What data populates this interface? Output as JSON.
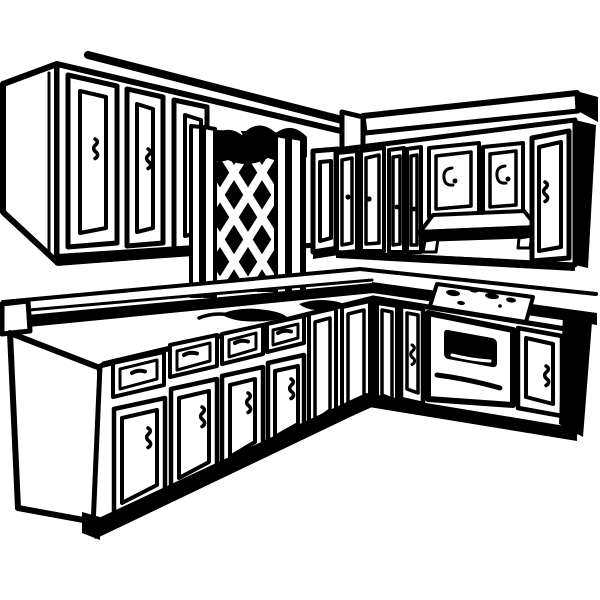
{
  "meta": {
    "alt": "Black and white clip-art line drawing of an L-shaped kitchen with upper cabinets, a lattice window, a range hood, a long countertop, base cabinets with drawers, and a built-in oven with cooktop burners.",
    "style": "black-and-white line illustration",
    "subject": "kitchen interior, corner perspective"
  },
  "palette": {
    "ink": "#000000",
    "paper": "#ffffff"
  },
  "scene": {
    "ceiling": {
      "trim_lines": 1
    },
    "upper_cabinets_left": {
      "side_panel": 1,
      "doors": 3,
      "partial_door": 1,
      "handle_style": "squiggle"
    },
    "lattice_window": {
      "type": "diamond lattice",
      "posts_left": 2,
      "posts_right": 2,
      "valance": true
    },
    "upper_cabinets_right": {
      "narrow_doors": 4,
      "square_doors_over_hood": 2,
      "wide_door": 1,
      "end_panel": "black",
      "handle_styles": [
        "dot",
        "spiral",
        "squiggle"
      ]
    },
    "range_hood": {
      "shape": "flared trapezoid",
      "supports": 2
    },
    "countertop": {
      "runs": 2,
      "corner": true,
      "sink_shadow": true,
      "faucet_mark": true,
      "end_cap_left": true
    },
    "cooktop": {
      "burner_marks": 5
    },
    "base_cabinets_left": {
      "drawer_door_units": 4,
      "narrow_end_panels": 2,
      "side_panel": 1,
      "toe_shadow": true,
      "foot_notch": true
    },
    "base_cabinets_right": {
      "corner_stile": 1,
      "doors": 2,
      "oven": {
        "window": true,
        "handle_bar": true
      },
      "end_panel": "black",
      "toe_shadow": true
    }
  }
}
